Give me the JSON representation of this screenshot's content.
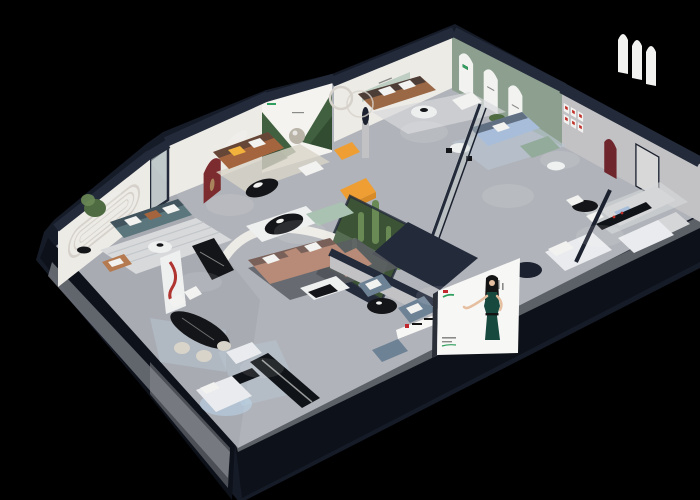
{
  "scene": {
    "type": "3d-isometric-showroom-render",
    "description": "Isometric dollhouse cutaway render of a furniture showroom with furnished room vignettes, a cactus atrium, wall murals and a front-face billboard of a woman in a dark green dress, on a black background",
    "background": "#000000",
    "text_legible": false
  },
  "palette": {
    "bg": "#000000",
    "shell": "#161b28",
    "wall_cap": "#232a3a",
    "wall_cap_dark": "#1b212e",
    "front_face": "#0d1119",
    "slab_grey": "#71747b",
    "slab_light": "#8b8e94",
    "floor": "#b0b3b9",
    "floor_dark": "#9b9ea6",
    "wall_white": "#edebe6",
    "wall_grey": "#c2c2c5",
    "wall_sage": "#8da08f",
    "groove": "#d6d2cb",
    "arch_red": "#7c2b2e",
    "arch_red_dark": "#6e262c",
    "mural_white": "#f4f3ef",
    "mural_green": "#41603f",
    "mural_green_dark": "#2e4730",
    "mural_ball": "#b9b3a8",
    "arch_white": "#f2f3f1",
    "sofa_teal": "#5b767c",
    "sofa_cognac": "#a4653e",
    "sofa_brown": "#9a6845",
    "sofa_blush": "#b78b77",
    "sofa_blue": "#a7bdd9",
    "sofa_green": "#93ab9a",
    "sofa_grey": "#d5d6d8",
    "sofa_steel": "#6e8296",
    "chaise_mint": "#a9c2b2",
    "armchair_tan": "#b57a4f",
    "accent_orange": "#ef9e33",
    "accent_orange_dark": "#d88a26",
    "pillow_white": "#f2f2f0",
    "pillow_amber": "#f2b23c",
    "plant_green": "#4e6b41",
    "cactus_green": "#6a8a55",
    "atrium_ground": "#3c5336",
    "hydrangea": "#e9ecea",
    "glass": "#cfdcd8",
    "rug_light": "#d7d9db",
    "rug_stripe": "#c3c6c9",
    "rug_beige": "#d9d4c9",
    "rug_blue": "#bac7d4",
    "rug_dark": "#5a5d63",
    "table_black": "#141518",
    "table_white": "#eef0f0",
    "bench_black": "#101317",
    "bed_white": "#e9ebee",
    "bed_glow": "#bcd9f2",
    "lamp_red": "#b03430",
    "bronze": "#a8835c",
    "billboard_bg": "#f7f7f5",
    "billboard_side": "#2a2f38",
    "dress_teal": "#17493f",
    "hair_black": "#141414",
    "skin": "#e5bf9f",
    "logo_red": "#c2272d",
    "logo_green": "#2f9e5f",
    "text_grey": "#8a8a88",
    "pic_red": "#c03028",
    "door_panel": "#d8d8d8",
    "spot_white": "#ffffff"
  },
  "rooms": [
    {
      "name": "living-room-teal",
      "wall_feature": "double stadium groove moulding",
      "furniture": [
        "teal three-seat sofa",
        "tan leather armchair",
        "white round coffee table",
        "potted plant",
        "striped grey rug"
      ]
    },
    {
      "name": "living-room-cognac",
      "wall_feature": "dark red arched niche with bronze figurine",
      "furniture": [
        "cognac leather sofa",
        "amber pillow",
        "black oval coffee table",
        "orange accent seats",
        "sculpture on pedestal",
        "beige rug"
      ]
    },
    {
      "name": "forest-mural-bay",
      "wall_feature": "forest mural with mirrored sphere and green brand logo"
    },
    {
      "name": "living-room-sage",
      "wall_feature": "sage green wall with three white arches",
      "furniture": [
        "brown leather sofa",
        "white armchair",
        "round coffee table",
        "ring floor lamp",
        "grey rug"
      ]
    },
    {
      "name": "living-room-blue",
      "furniture": [
        "powder blue sofa",
        "green loveseat",
        "white side table",
        "blue-grey rug",
        "glass partition"
      ]
    },
    {
      "name": "suite-right",
      "wall_feature": "red arched niche, six red-framed prints, white arch frames",
      "furniture": [
        "light grey modular sofa",
        "black dining table with chairs",
        "white beds"
      ]
    },
    {
      "name": "cactus-atrium",
      "furniture": [
        "glass enclosure",
        "cacti",
        "white hydrangea",
        "moss ground"
      ]
    },
    {
      "name": "lounge-blush",
      "furniture": [
        "blush sectional with chaise",
        "mint chaise",
        "white-black coffee table",
        "black oval table on platform",
        "curved white partition",
        "dark grey rug"
      ]
    },
    {
      "name": "dining-area",
      "furniture": [
        "black marble oval table",
        "cream chairs",
        "white high-back chairs",
        "red tube floor lamp",
        "white display shelf",
        "black marble console",
        "blue patterned rug"
      ]
    },
    {
      "name": "lounge-steel-blue",
      "furniture": [
        "two steel blue armchairs",
        "black round coffee table",
        "ottoman",
        "white brand sign with red logo"
      ]
    },
    {
      "name": "front-bedroom",
      "furniture": [
        "white bed with under-glow",
        "long black bench",
        "white daybed",
        "blue patterned rug",
        "dark round rug"
      ]
    }
  ],
  "billboard": {
    "subject": "woman with long black hair in a dark green evening dress, left palm raised",
    "panel_color": "#f7f7f5",
    "logo_colors": [
      "#c2272d",
      "#2f9e5f"
    ],
    "text_legible": false
  },
  "signage": [
    {
      "name": "brand-sign-interior",
      "colors": [
        "#f4f4f2",
        "#c2272d",
        "#222222"
      ]
    },
    {
      "name": "mural-logo",
      "color": "#2f9e5f"
    },
    {
      "name": "arch-poster-logo",
      "color": "#4a90c4"
    }
  ]
}
